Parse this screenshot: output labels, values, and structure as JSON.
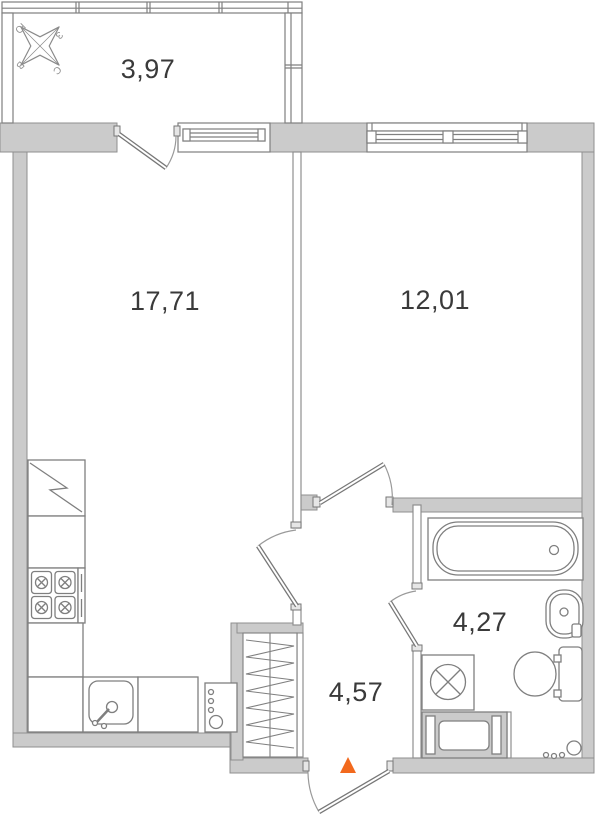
{
  "title": "Apartment floor plan",
  "rooms": {
    "balcony": {
      "area": "3,97"
    },
    "living_room": {
      "area": "17,71"
    },
    "bedroom": {
      "area": "12,01"
    },
    "bathroom": {
      "area": "4,27"
    },
    "hallway": {
      "area": "4,57"
    }
  },
  "compass": {
    "south": "Ю",
    "west": "З",
    "east": "В",
    "north": "С"
  },
  "colors": {
    "entrance_marker": "#f2691d",
    "wall_fill": "#cbcbcb",
    "line": "#808080",
    "label_text": "#3a3a3a"
  }
}
